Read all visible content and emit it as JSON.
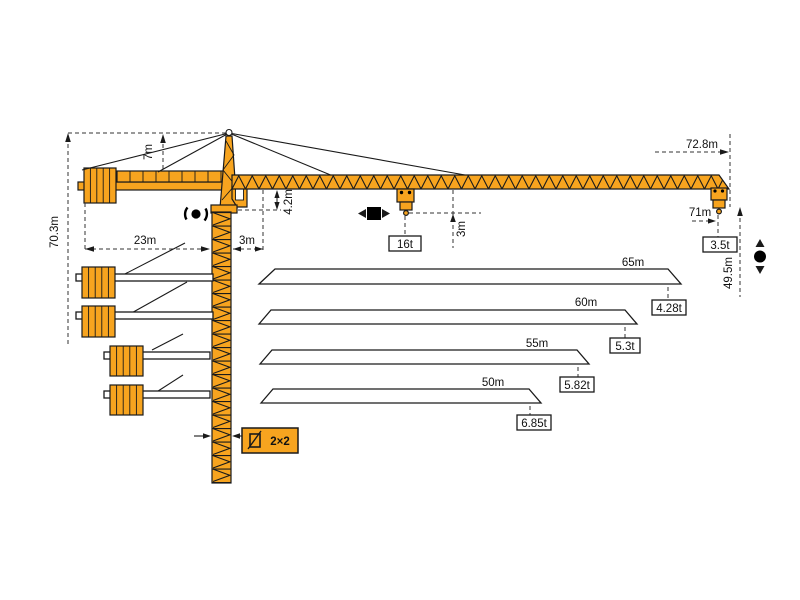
{
  "colors": {
    "crane_orange": "#F7A41F",
    "outline": "#1a1a1a"
  },
  "labels": {
    "total_height": "70.3m",
    "tower_top_height": "7m",
    "counter_jib_radius": "23m",
    "rear_offset": "3m",
    "jib_depth": "4.2m",
    "hook_to_jib": "3m",
    "max_capacity": "16t",
    "max_radius": "72.8m",
    "tip_radius": "71m",
    "tip_capacity": "3.5t",
    "hook_height": "49.5m",
    "mast_section": "2×2"
  },
  "load_chart": {
    "type": "table",
    "title": "Jib length vs. tip capacity",
    "rows": [
      {
        "jib_length": "65m",
        "capacity": "4.28t"
      },
      {
        "jib_length": "60m",
        "capacity": "5.3t"
      },
      {
        "jib_length": "55m",
        "capacity": "5.82t"
      },
      {
        "jib_length": "50m",
        "capacity": "6.85t"
      }
    ]
  }
}
